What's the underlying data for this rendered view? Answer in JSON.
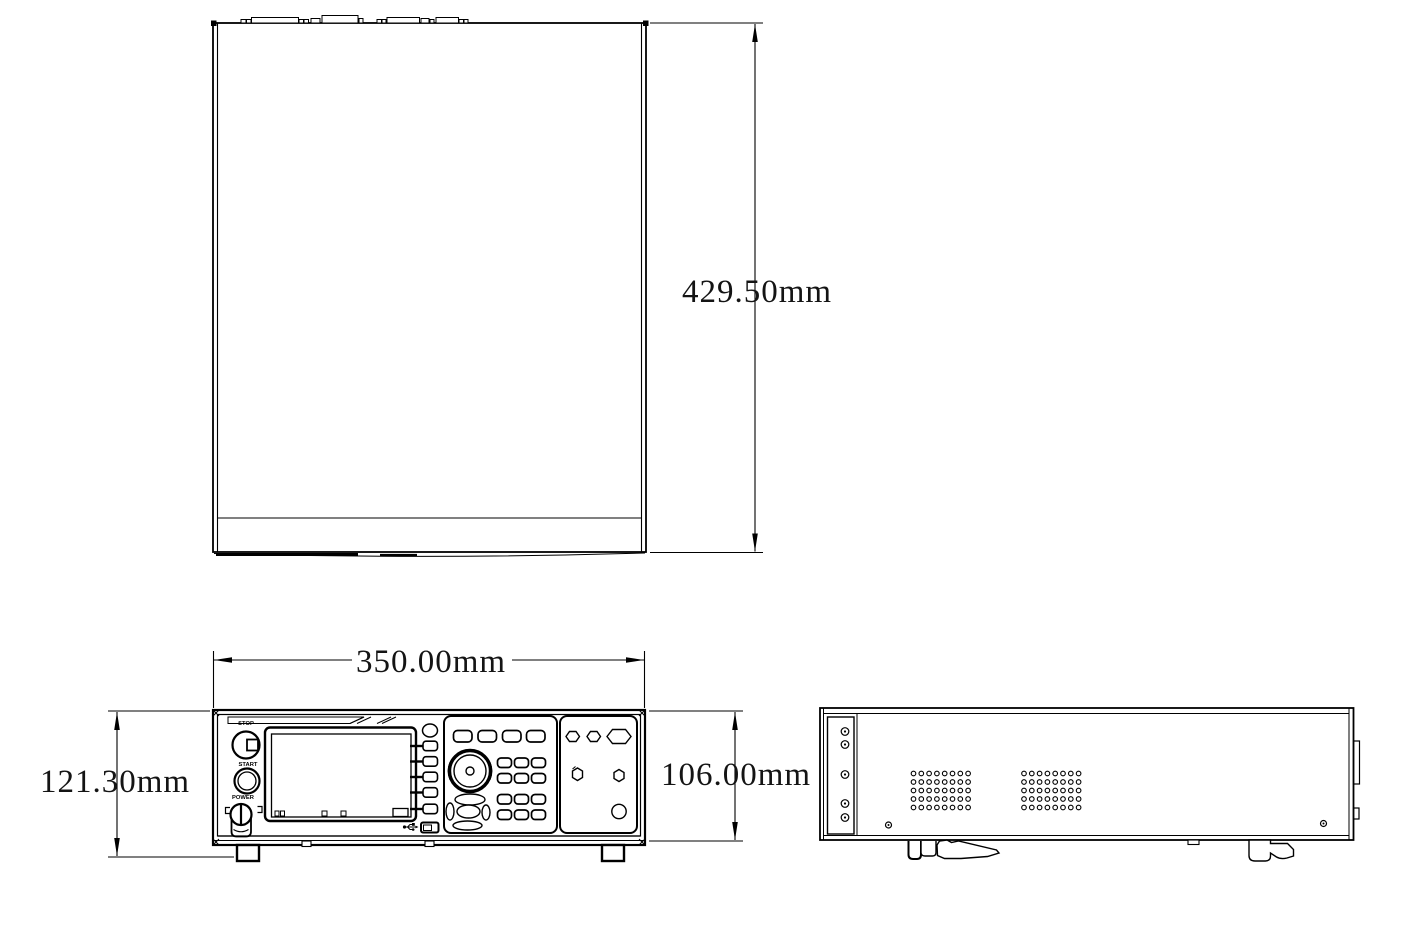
{
  "page": {
    "background": "#ffffff",
    "line_color": "#000000"
  },
  "dimensions": {
    "depth": "429.50mm",
    "width": "350.00mm",
    "overall_height": "121.30mm",
    "body_height": "106.00mm"
  },
  "panel_labels": {
    "stop": "STOP",
    "start": "START",
    "power": "POWER"
  }
}
